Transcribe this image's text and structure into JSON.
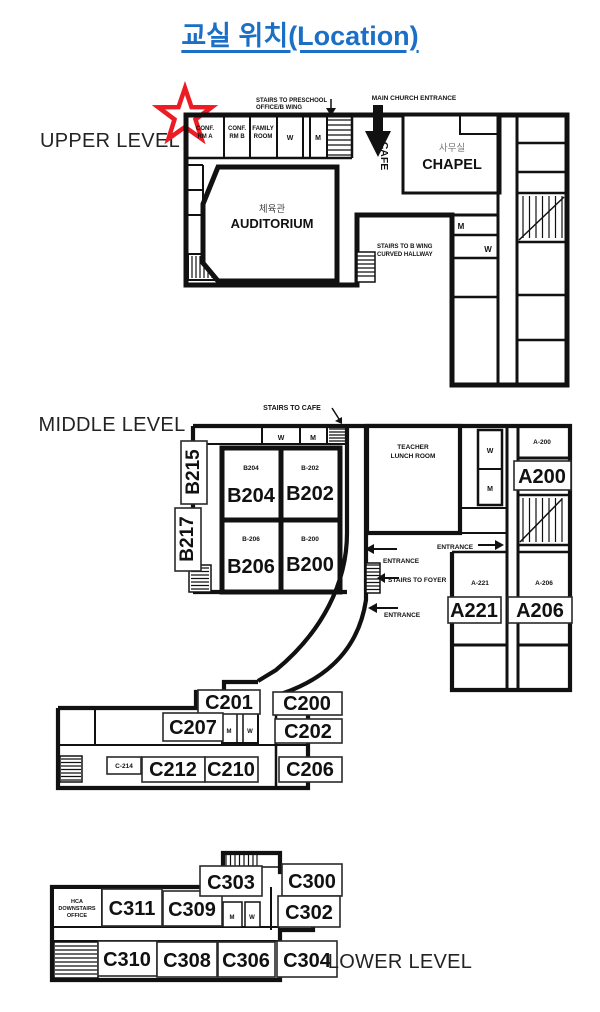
{
  "title": "교실 위치(Location)",
  "colors": {
    "title_blue": "#1B6FC4",
    "star_red": "#EC1C24",
    "ink": "#111111"
  },
  "levels": {
    "upper": "UPPER LEVEL",
    "middle": "MIDDLE LEVEL",
    "lower": "LOWER LEVEL"
  },
  "upper": {
    "conf_a": {
      "l1": "CONF.",
      "l2": "RM A"
    },
    "conf_b": {
      "l1": "CONF.",
      "l2": "RM B"
    },
    "family": {
      "l1": "FAMILY",
      "l2": "ROOM"
    },
    "w_top": "W",
    "m_top": "M",
    "stairs_preschool": {
      "l1": "STAIRS TO PRESCHOOL",
      "l2": "OFFICE/B WING"
    },
    "main_entrance": "MAIN CHURCH ENTRANCE",
    "cafe": "CAFE",
    "chapel_kr": "사무실",
    "chapel": "CHAPEL",
    "auditorium_kr": "체육관",
    "auditorium": "AUDITORIUM",
    "stairs_bwing": {
      "l1": "STAIRS TO B WING",
      "l2": "CURVED HALLWAY"
    },
    "m_right": "M",
    "w_right": "W"
  },
  "middle": {
    "stairs_cafe": "STAIRS TO CAFE",
    "w_top": "W",
    "m_top": "M",
    "b215": "B215",
    "b217": "B217",
    "b204_s": "B204",
    "b202_s": "B-202",
    "b206_s": "B-206",
    "b200_s": "B-200",
    "b204": "B204",
    "b202": "B202",
    "b206": "B206",
    "b200": "B200",
    "teacher": {
      "l1": "TEACHER",
      "l2": "LUNCH ROOM"
    },
    "w_mid": "W",
    "m_mid": "M",
    "entrance_right": "ENTRANCE",
    "entrance_1": "ENTRANCE",
    "stairs_foyer": "STAIRS TO FOYER",
    "entrance_2": "ENTRANCE",
    "a200_s": "A-200",
    "a200": "A200",
    "a221_s": "A-221",
    "a221": "A221",
    "a206_s": "A-206",
    "a206": "A206",
    "c201": "C201",
    "c207": "C207",
    "c200": "C200",
    "c202": "C202",
    "c214_s": "C-214",
    "c212": "C212",
    "c210": "C210",
    "c206": "C206",
    "m_c": "M",
    "w_c": "W"
  },
  "lower": {
    "hca": {
      "l1": "HCA",
      "l2": "DOWNSTAIRS",
      "l3": "OFFICE"
    },
    "c311": "C311",
    "c309": "C309",
    "c303": "C303",
    "c300": "C300",
    "c302": "C302",
    "c310": "C310",
    "c308": "C308",
    "c306": "C306",
    "c304": "C304",
    "m": "M",
    "w": "W"
  }
}
